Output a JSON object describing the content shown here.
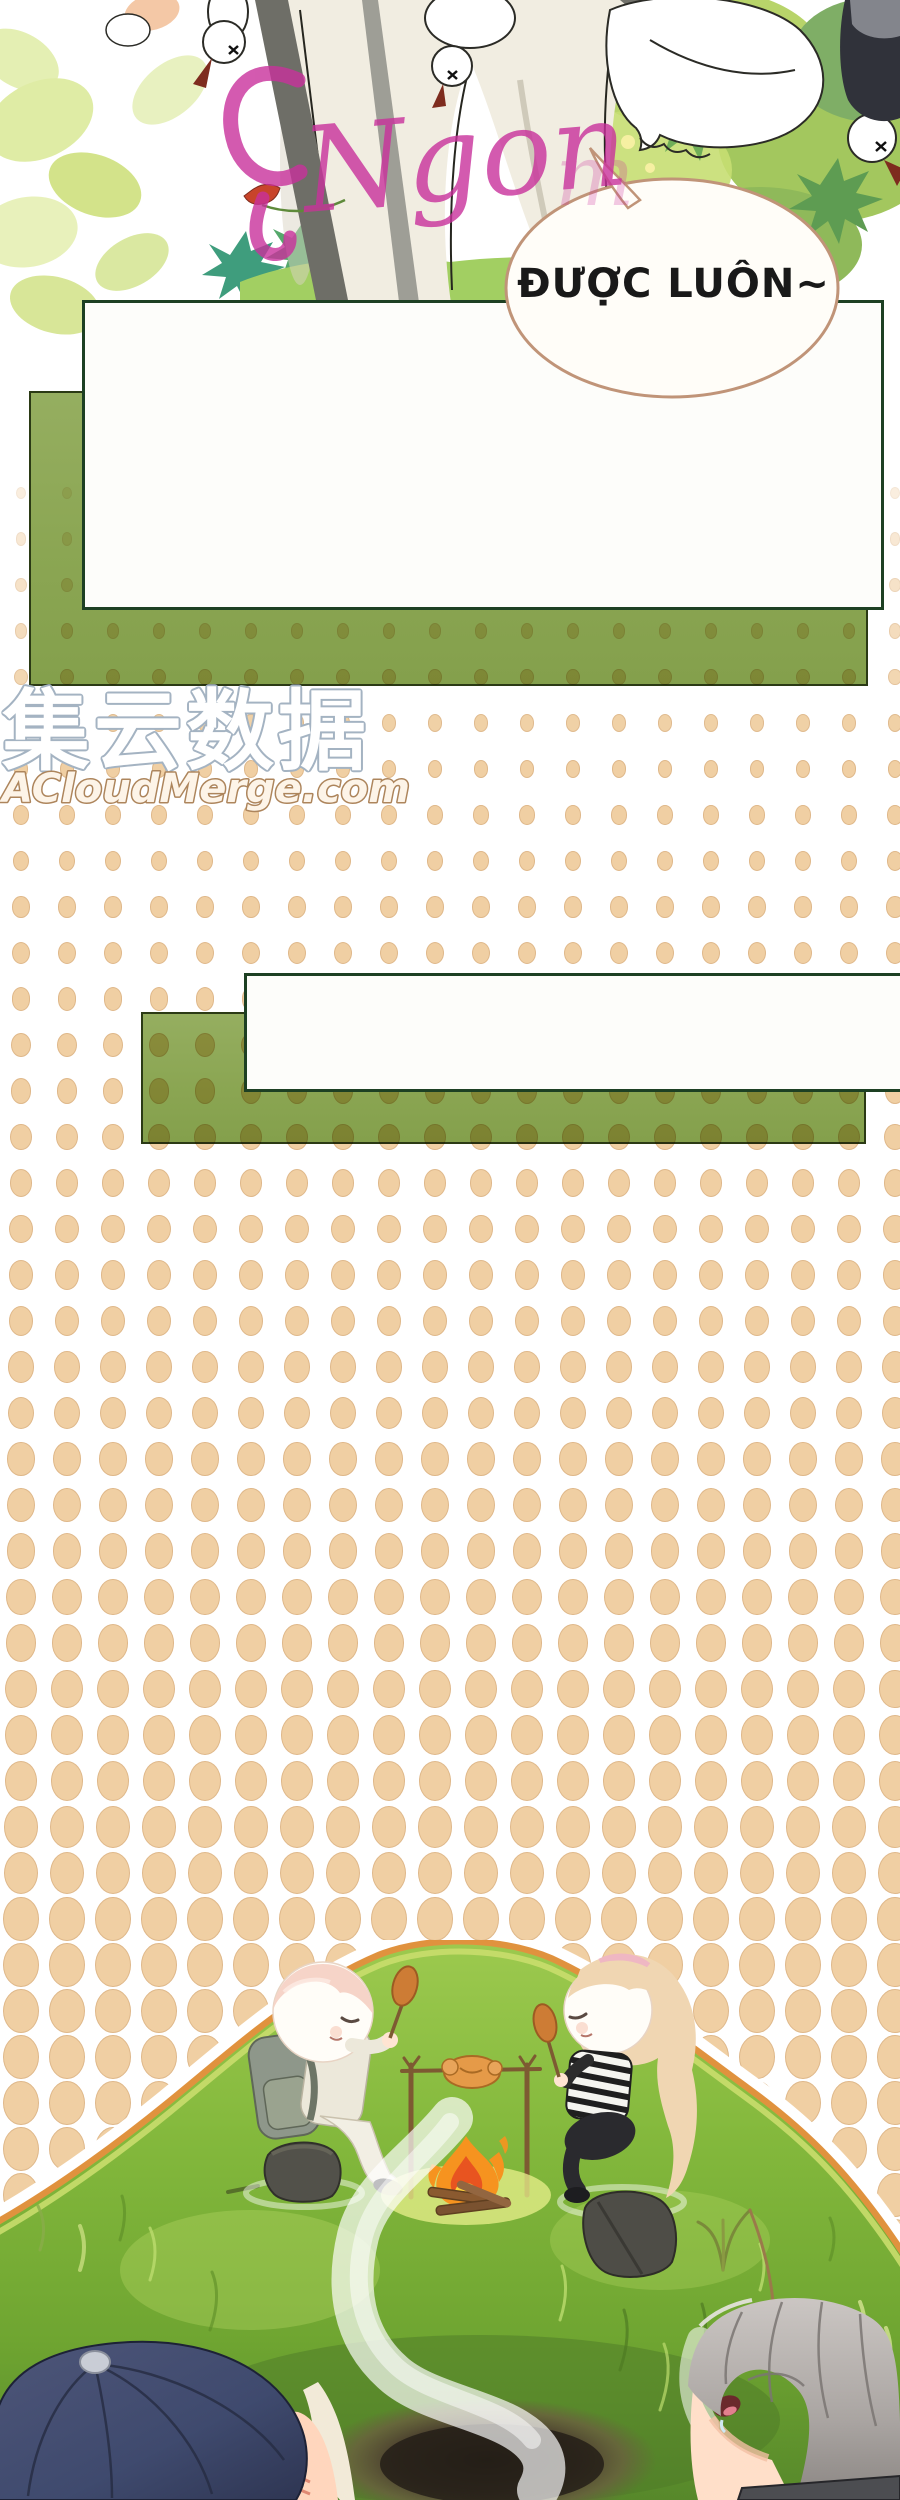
{
  "page": {
    "kind_label": "manhua comic page",
    "background": "#ffffff",
    "width": 900,
    "height": 2500
  },
  "speech_bubble": {
    "text": "ĐƯỢC LUÔN~",
    "fill": "#fffdf8",
    "border": "#c09478",
    "text_color": "#191919"
  },
  "script_watermark": {
    "text": "Ngon",
    "faint_tail": "m",
    "color": "#c9319c"
  },
  "site_watermark": {
    "cn_text": "集云数据",
    "cn_fill": "#ffffff",
    "cn_outline": "#a4b3c2",
    "en_text": "ACloudMerge.com",
    "en_fill": "#fdf4e8",
    "en_outline": "#ad855c"
  },
  "dialog_boxes": {
    "white_fill": "#fdfdfa",
    "white_border": "#1d4023",
    "green_fill": "#8ba653",
    "green_border": "#2b3a15"
  },
  "halftone": {
    "dot_fill": "#f0cfa3",
    "dot_edge": "#c59664",
    "pitch_px": 46,
    "min_size_px": 8,
    "max_size_px": 34
  },
  "scene_colors": {
    "grass": "#83b83c",
    "mound_outline": "#e0923e",
    "mound_inner_edge": "#c9dd6d",
    "fire_outer": "#f6931f",
    "fire_inner": "#e85420",
    "fire_core": "#ffd23c",
    "smoke": "#ffffff",
    "pit": "#2a241c",
    "cap": "#3f4a6e",
    "boy_hair": "#f6d4c8",
    "girl_hair": "#f0d6b2",
    "gray_hair": "#b9b4b1",
    "rock": "#52514a",
    "backpack": "#8e978a",
    "leaves_light": "#d9e897",
    "leaves_dark": "#6fae58",
    "goose": "#ffffff",
    "beak": "#7e2c1e"
  }
}
